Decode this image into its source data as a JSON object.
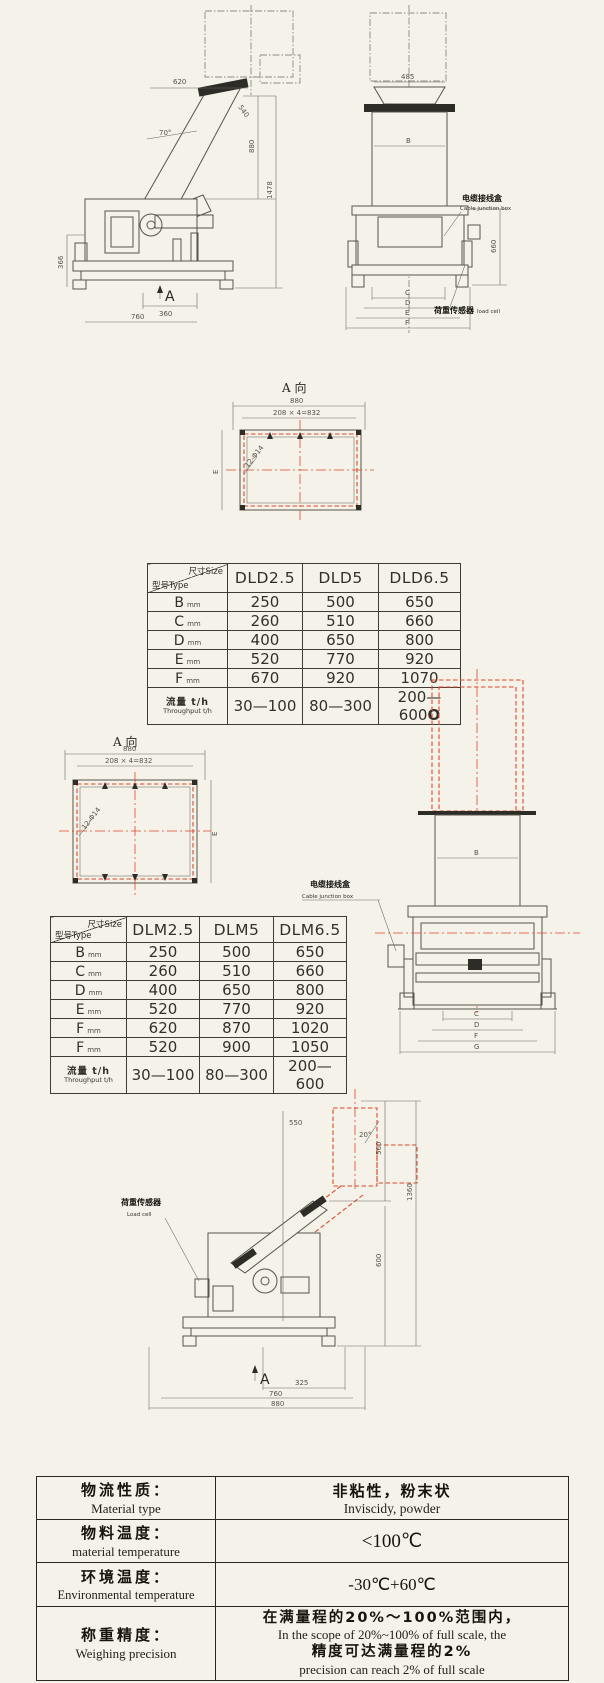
{
  "dwg_side1": {
    "dim_top": "620",
    "dim_angle": "70°",
    "dim_flange": "540",
    "dim_h1": "880",
    "dim_h2": "1478",
    "dim_left": "366",
    "dim_b1": "360",
    "dim_b2": "760",
    "view_arrow": "A"
  },
  "dwg_front1": {
    "dim_top": "485",
    "dim_b": "B",
    "dim_right": "660",
    "dims_bottom": [
      "C",
      "D",
      "E",
      "F"
    ],
    "junction_cn": "电缆接线盒",
    "junction_en": "Cable junction box",
    "loadcell_cn": "荷重传感器",
    "loadcell_en": "load cell"
  },
  "viewA1": {
    "title": "A 向",
    "dim_w": "880",
    "dim_holes": "208 × 4=832",
    "holes": "12-Φ14",
    "dim_e": "E"
  },
  "table1": {
    "corner_size": "尺寸Size",
    "corner_type": "型号Type",
    "unit": "mm",
    "columns": [
      "DLD2.5",
      "DLD5",
      "DLD6.5"
    ],
    "rows": [
      {
        "label": "B",
        "values": [
          "250",
          "500",
          "650"
        ]
      },
      {
        "label": "C",
        "values": [
          "260",
          "510",
          "660"
        ]
      },
      {
        "label": "D",
        "values": [
          "400",
          "650",
          "800"
        ]
      },
      {
        "label": "E",
        "values": [
          "520",
          "770",
          "920"
        ]
      },
      {
        "label": "F",
        "values": [
          "670",
          "920",
          "1070"
        ]
      }
    ],
    "tp_cn": "流量 t/h",
    "tp_en": "Throughput t/h",
    "tp": [
      "30—100",
      "80—300",
      "200—600"
    ],
    "tp_suffix": "O"
  },
  "viewA2": {
    "title": "A 向",
    "dim_w": "880",
    "dim_holes": "208 × 4=832",
    "holes": "12-Φ14",
    "dim_e": "E"
  },
  "table2": {
    "corner_size": "尺寸Size",
    "corner_type": "型号Type",
    "unit": "mm",
    "columns": [
      "DLM2.5",
      "DLM5",
      "DLM6.5"
    ],
    "rows": [
      {
        "label": "B",
        "values": [
          "250",
          "500",
          "650"
        ]
      },
      {
        "label": "C",
        "values": [
          "260",
          "510",
          "660"
        ]
      },
      {
        "label": "D",
        "values": [
          "400",
          "650",
          "800"
        ]
      },
      {
        "label": "E",
        "values": [
          "520",
          "770",
          "920"
        ]
      },
      {
        "label": "F",
        "values": [
          "620",
          "870",
          "1020"
        ]
      },
      {
        "label": "F",
        "values": [
          "520",
          "900",
          "1050"
        ]
      }
    ],
    "tp_cn": "流量 t/h",
    "tp_en": "Throughput t/h",
    "tp": [
      "30—100",
      "80—300",
      "200—600"
    ]
  },
  "dwg_front2": {
    "dim_b": "B",
    "dims_bottom": [
      "C",
      "D",
      "F",
      "G"
    ],
    "junction_cn": "电缆接线盒",
    "junction_en": "Cable junction box"
  },
  "dwg_side2": {
    "dim_top": "550",
    "dim_angle": "20°",
    "dim_h1": "560",
    "dim_h2": "1360",
    "dim_h3": "600",
    "dim_b1": "325",
    "dim_b2": "760",
    "dim_b3": "880",
    "view_arrow": "A",
    "loadcell_cn": "荷重传感器",
    "loadcell_en": "Load cell"
  },
  "spec": {
    "rows": [
      {
        "cn": "物流性质：",
        "en": "Material type",
        "val_cn": "非粘性，粉末状",
        "val_en": "Inviscidy, powder"
      },
      {
        "cn": "物料温度：",
        "en": "material temperature",
        "val": "<100℃"
      },
      {
        "cn": "环境温度：",
        "en": "Environmental temperature",
        "val": "-30℃+60℃"
      },
      {
        "cn": "称重精度：",
        "en": "Weighing precision",
        "val_cn": "在满量程的20%～100%范围内，",
        "val_en": "In the scope of 20%~100% of full scale, the",
        "val_cn2": "精度可达满量程的2%",
        "val_en2": "precision can reach 2% of full scale"
      }
    ]
  }
}
